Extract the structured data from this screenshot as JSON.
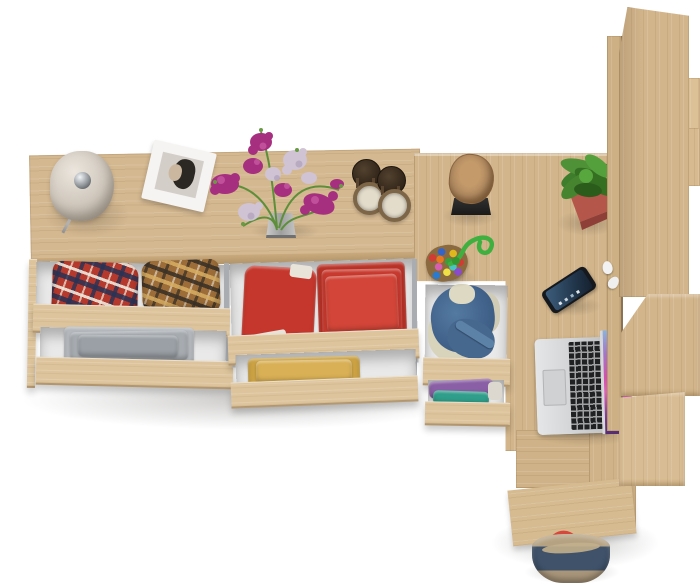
{
  "meta": {
    "kind": "furniture-product-render",
    "view": "top-down",
    "description": "Top view of a Sonoma oak chest of drawers with open clothes drawers, joined to an L-shaped desk with tall shelving, styled with decor objects on a white background."
  },
  "palette": {
    "background": "#ffffff",
    "oak": "#d4b890",
    "oak_strip": "#ddc49c",
    "oak_edge": "#b2946a",
    "drawer_interior": "#e9e9e9",
    "metal_slide": "#a9adb1",
    "lamp_shade": "#cfc7bc",
    "chrome": "#8f9499",
    "frame_white": "#f5f4f2",
    "photo_grey": "#d3cec8",
    "flower_magenta": "#a62f80",
    "flower_pale": "#cfc3d4",
    "stem_green": "#5d8f3a",
    "lantern_bronze": "#3f3122",
    "lantern_ring": "#7d6547",
    "candle": "#e3dccb",
    "stool_wood": "#a8835c",
    "stool_base": "#262626",
    "toy_rope": "#3fb03f",
    "plant_green": "#3e7d2b",
    "pot_red": "#b5564a",
    "phone_body": "#15181c",
    "laptop_silver": "#d5d7d9",
    "laptop_keys": "#1f2123",
    "screen_pink": "#d44fae",
    "screen_blue": "#8ab4dc",
    "screen_purple": "#4e2a6e",
    "earbud_white": "#f2f2f2",
    "grey_cloth": "#a6abb0",
    "red_cloth": "#c8392e",
    "yellow_cloth": "#d9b055",
    "denim_blue": "#46688f",
    "denim_cream": "#d8d4bc",
    "purple_cloth": "#8a5fa5",
    "teal_cloth": "#2f9e8a",
    "bag_navy": "#3f526a",
    "bag_tan": "#b5a282",
    "bag_strap": "#d6473c"
  },
  "scene": {
    "furniture": [
      {
        "id": "dresser",
        "label": "Oak chest of drawers with three open drawer columns"
      },
      {
        "id": "desk",
        "label": "L-shaped oak desk return"
      },
      {
        "id": "shelf-tower",
        "label": "Tall oak shelving unit on the right"
      }
    ],
    "objects": [
      {
        "id": "table-lamp",
        "label": "Beige dome table lamp with chrome cap"
      },
      {
        "id": "picture-frame",
        "label": "White tilted frame with black-and-white portrait"
      },
      {
        "id": "flower-bouquet",
        "label": "Magenta and pale lilac flowers in a small grey vase"
      },
      {
        "id": "candle-lanterns",
        "label": "Two bronze candle lanterns"
      },
      {
        "id": "log-stool",
        "label": "Natural log stool on a black base"
      },
      {
        "id": "felt-ball-charm",
        "label": "Multicolour felt-ball charm with green cord"
      },
      {
        "id": "potted-plant",
        "label": "Green plant in a red square pot"
      },
      {
        "id": "smartphone",
        "label": "Black smartphone lying on the desk"
      },
      {
        "id": "laptop",
        "label": "Open silver laptop with colourful screen"
      },
      {
        "id": "earbuds",
        "label": "White earbuds near the shelf edge"
      },
      {
        "id": "tote-bag",
        "label": "Navy and tan canvas tote bag with red rope straps"
      }
    ],
    "drawer_contents": [
      {
        "id": "drawer-plaid",
        "label": "Plaid shirts (red/navy and brown/tan)"
      },
      {
        "id": "drawer-grey",
        "label": "Grey folded trousers"
      },
      {
        "id": "drawer-red",
        "label": "Red shorts and folded red shirts"
      },
      {
        "id": "drawer-yellow",
        "label": "Yellow folded knitwear"
      },
      {
        "id": "drawer-denim",
        "label": "Blue denim bundle with cream lining"
      },
      {
        "id": "drawer-purple-teal",
        "label": "Purple and teal tops"
      }
    ]
  }
}
